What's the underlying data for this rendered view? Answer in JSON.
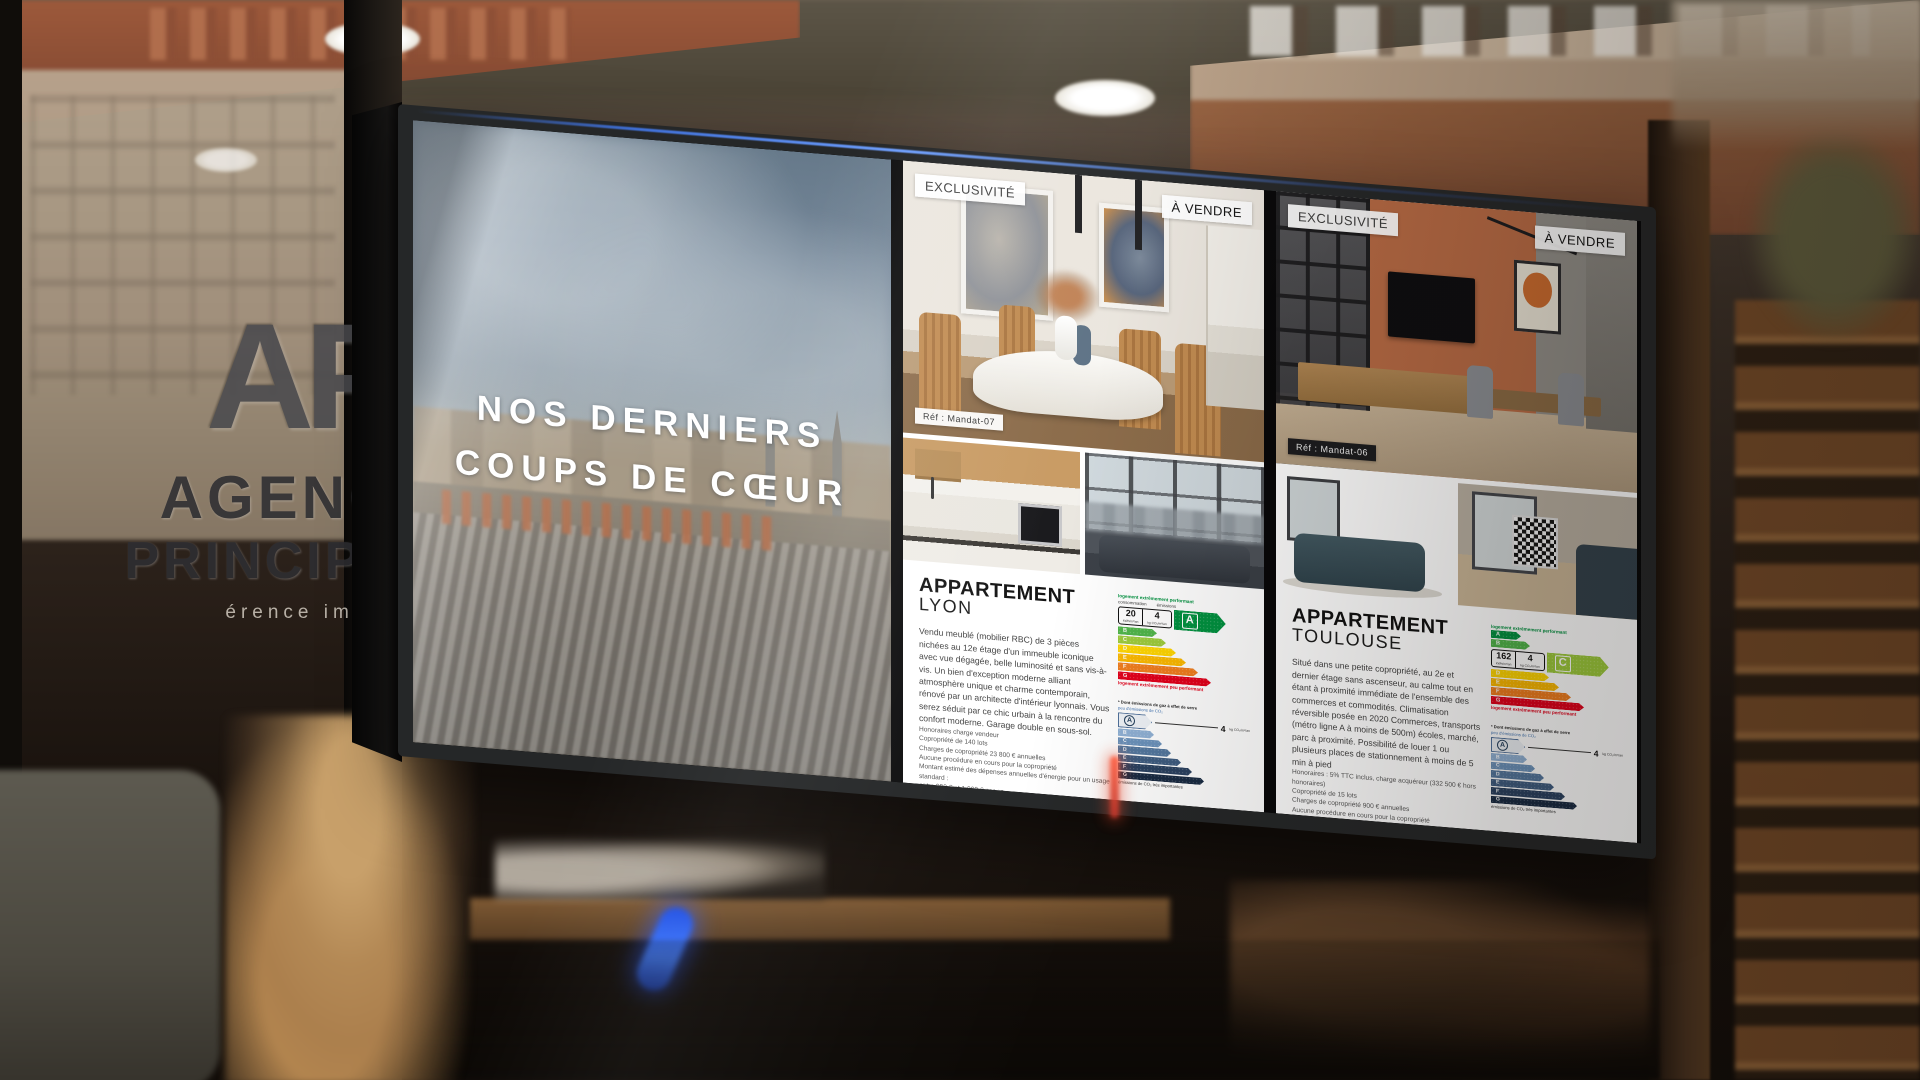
{
  "glass_branding": {
    "monogram": "AP",
    "name_line1": "AGENCE",
    "name_line2": "PRINCIPALE",
    "tagline": "érence imm"
  },
  "screen": {
    "left_panel": {
      "heading_line1": "NOS DERNIERS",
      "heading_line2": "COUPS DE CŒUR"
    },
    "energy_scale": {
      "letters": [
        "A",
        "B",
        "C",
        "D",
        "E",
        "F",
        "G"
      ],
      "dpe_colors": [
        "#00913f",
        "#4fb549",
        "#9dcb3b",
        "#ffd500",
        "#fbb800",
        "#f07d1d",
        "#e2001a"
      ],
      "ges_colors": [
        "#eef2f7",
        "#8fb0d4",
        "#6b92bb",
        "#53779e",
        "#3e5c80",
        "#2a4160",
        "#182a42"
      ],
      "dpe_header_consumption": "consommation",
      "dpe_header_emissions": "émissions",
      "dpe_unit_consumption": "kWh/m²/an",
      "dpe_unit_emissions": "kg CO₂/m²/an",
      "dpe_caption_top": "logement extrêmement performant",
      "dpe_caption_bottom": "logement extrêmement peu performant",
      "ges_title": "* Dont émissions de gaz à effet de serre",
      "ges_caption_top": "peu d'émissions de CO₂",
      "ges_caption_bottom": "émissions de CO₂ très importantes"
    },
    "listings": [
      {
        "badge_exclusivity": "EXCLUSIVITÉ",
        "badge_sale": "À VENDRE",
        "ref": "Réf : Mandat-07",
        "title_line1": "APPARTEMENT",
        "title_line2": "LYON",
        "description": "Vendu meublé (mobilier RBC) de 3 pièces nichées au 12e étage d'un immeuble iconique avec vue dégagée, belle luminosité et sans vis-à-vis. Un bien d'exception moderne alliant atmosphère unique et charme contemporain, rénové par un architecte d'intérieur lyonnais. Vous serez séduit par ce chic urbain à la rencontre du confort moderne. Garage double en sous-sol.",
        "legal_lines": [
          "Honoraires charge vendeur",
          "Copropriété de 140 lots",
          "Charges de copropriété 23 800 € annuelles",
          "Aucune procédure en cours pour la copropriété",
          "Montant estimé des dépenses annuelles d'énergie pour un usage standard :",
          "entre 900 € et 1 000 € par an",
          "Prix moyen des énergies indexés au 2021 (abonnement compris)."
        ],
        "price": "1 100 000 €",
        "dpe_value_consumption": "20",
        "dpe_value_emissions": "4",
        "dpe_class": "A",
        "ges_class": "A",
        "ges_value": "4",
        "ges_unit": "kg CO₂/m²/an",
        "brand_light": "VITRINE",
        "brand_bold": "MEDIA"
      },
      {
        "badge_exclusivity": "EXCLUSIVITÉ",
        "badge_sale": "À VENDRE",
        "ref": "Réf : Mandat-06",
        "title_line1": "APPARTEMENT",
        "title_line2": "TOULOUSE",
        "description": "Situé dans une petite copropriété, au 2e et dernier étage sans ascenseur, au calme tout en étant à proximité immédiate de l'ensemble des commerces et commodités. Climatisation réversible posée en 2020 Commerces, transports (métro ligne A à moins de 500m) écoles, marché, parc à proximité. Possibilité de louer 1 ou plusieurs places de stationnement à moins de 5 min à pied",
        "legal_lines": [
          "Honoraires : 5% TTC inclus, charge acquéreur (332 500 € hors honoraires)",
          "Copropriété de 15 lots",
          "Charges de copropriété 900 € annuelles",
          "Aucune procédure en cours pour la copropriété",
          "Montant estimé des dépenses annuelles d'énergie pour un usage standard :",
          "entre 900 € et 1 300 € par an",
          "Prix moyen des énergies indexés au 2021 (abonnement compris)."
        ],
        "price": "350 000 €",
        "dpe_value_consumption": "162",
        "dpe_value_emissions": "4",
        "dpe_class": "C",
        "ges_class": "A",
        "ges_value": "4",
        "ges_unit": "kg CO₂/m²/an",
        "brand_light": "VITRINE",
        "brand_bold": "MEDIA"
      }
    ]
  }
}
